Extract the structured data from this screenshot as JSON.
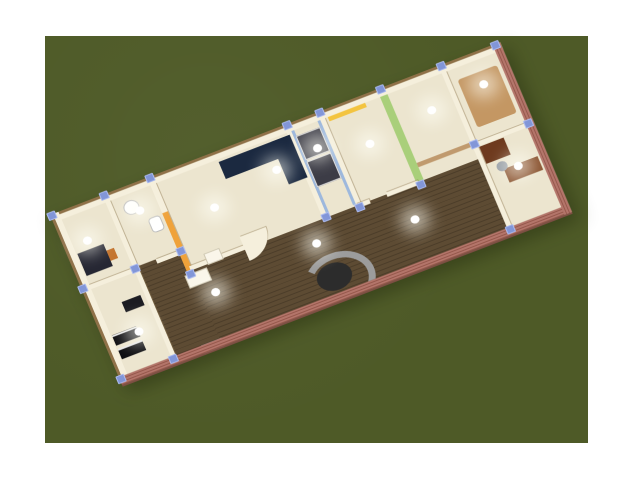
{
  "app": {
    "name": "home-design-3d-render",
    "view": "aerial-3d-floorplan"
  },
  "canvas": {
    "background": "#ffffff",
    "ground": "#4e5a27"
  },
  "palette": {
    "grass": "#4e5a27",
    "wall-cream": "#f5efdc",
    "floor-cream": "#ece5cf",
    "wood-floor": "#5d4b33",
    "brick": "#b3756a",
    "brick-dark": "#96584c",
    "wall-cap-brown": "#8f7148",
    "accent-orange": "#efa23a",
    "accent-yellow": "#f3c440",
    "accent-green": "#a9cf7a",
    "accent-blue": "#9db8dd",
    "accent-tan": "#c09a6e",
    "carpet-tan": "#c49763",
    "sofa-navy": "#1b2940",
    "furniture-black": "#0e0e12",
    "desk-brown": "#6e3a1e",
    "desk-brown-light": "#8a5330",
    "stair-gray": "#9c9c9c",
    "stair-dark": "#2c2c2c",
    "post-blue": "#8296d8",
    "light-white": "#ffffff"
  },
  "scene": {
    "rooms": [
      {
        "name": "left-bedroom",
        "accent": "tan walls",
        "furniture": [
          "dark-dresser"
        ]
      },
      {
        "name": "bathroom",
        "furniture": [
          "sink",
          "toilet"
        ]
      },
      {
        "name": "lower-left-kitchen",
        "furniture": [
          "black-counters"
        ]
      },
      {
        "name": "living-room",
        "accent": "orange wall",
        "furniture": [
          "navy-l-sofa",
          "white-tables"
        ]
      },
      {
        "name": "pantry-corridor",
        "accent": "blue walls",
        "furniture": [
          "tall-dark-cabinets"
        ]
      },
      {
        "name": "bedroom",
        "accent": "yellow band + green wall"
      },
      {
        "name": "hallway",
        "accent": "tan wall",
        "floor": "dark-wood",
        "furniture": [
          "curved-staircase"
        ]
      },
      {
        "name": "walk-in-closet",
        "floor": "tan-carpet"
      },
      {
        "name": "office",
        "furniture": [
          "brown-desk",
          "brown-cabinet",
          "chair"
        ]
      }
    ],
    "lights_count": 13,
    "wall_post_markers": 18,
    "exterior": {
      "front": "brick with small windows and white door",
      "back": "cream walls with brown cap"
    }
  }
}
